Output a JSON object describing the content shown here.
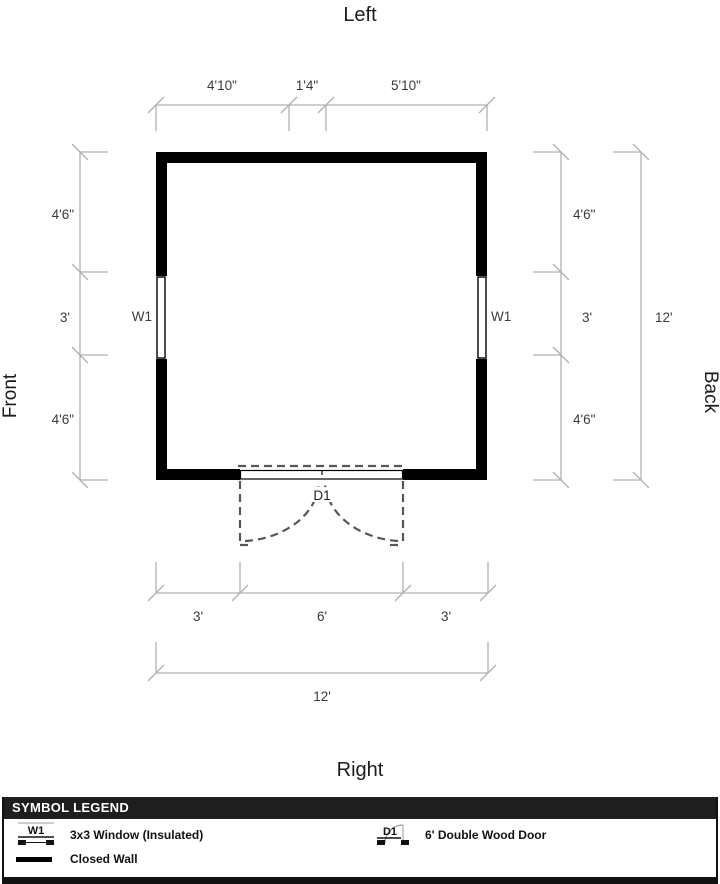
{
  "diagram": {
    "orientation_labels": {
      "top": "Left",
      "bottom": "Right",
      "left": "Front",
      "right": "Back"
    },
    "top_dimensions": {
      "segments": [
        "4'10\"",
        "1'4\"",
        "5'10\""
      ]
    },
    "left_dimensions": {
      "segments": [
        "4'6\"",
        "3'",
        "4'6\""
      ]
    },
    "right_dimensions": {
      "segments": [
        "4'6\"",
        "3'",
        "4'6\""
      ],
      "total": "12'"
    },
    "bottom_dimensions": {
      "segments": [
        "3'",
        "6'",
        "3'"
      ],
      "total": "12'"
    },
    "windows": {
      "left_label": "W1",
      "right_label": "W1"
    },
    "door": {
      "label": "D1"
    }
  },
  "legend": {
    "header": "SYMBOL LEGEND",
    "items": [
      {
        "symbol": "W1",
        "label": "3x3 Window (Insulated)"
      },
      {
        "symbol": "D1",
        "label": "6' Double Wood Door"
      },
      {
        "symbol": "",
        "label": "Closed Wall"
      }
    ]
  },
  "colors": {
    "wall": "#000000",
    "dimension_line": "#b0b0b0",
    "dimension_text": "#3a3a3a",
    "door_dash": "#575757",
    "legend_header_bg": "#1e1e1e",
    "legend_header_text": "#ffffff"
  }
}
